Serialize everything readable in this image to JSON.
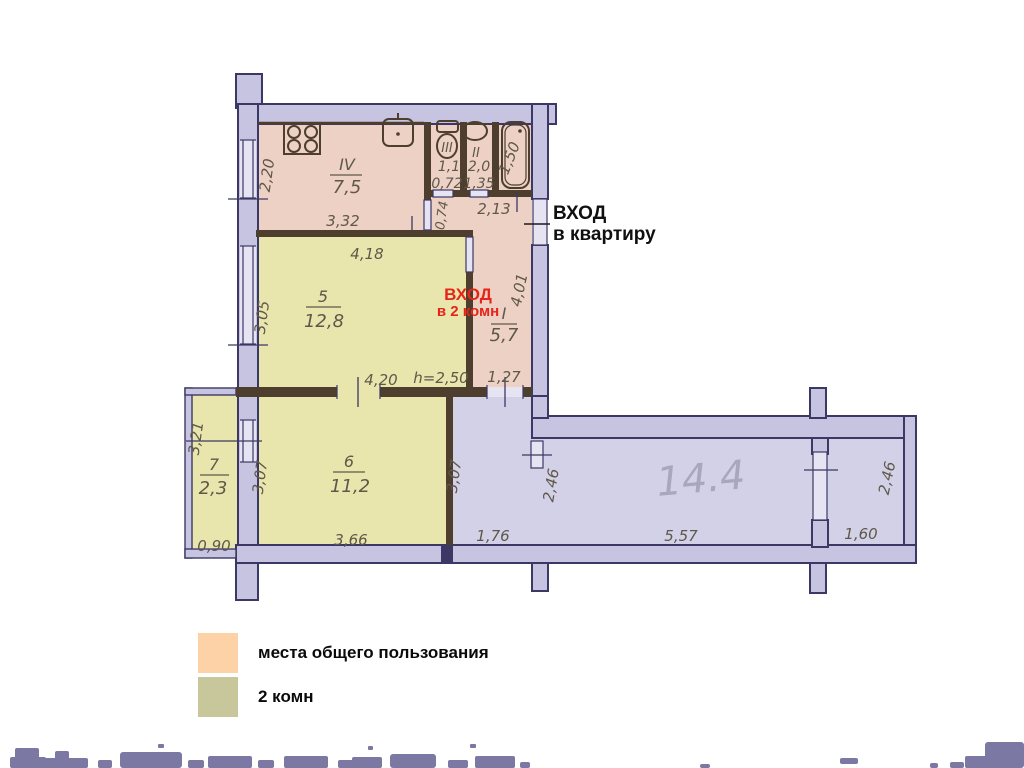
{
  "plan": {
    "rooms": {
      "kitchen": {
        "number": "IV",
        "area": "7,5",
        "dim_left": "2,20",
        "dim_bottom": "3,32"
      },
      "wc": {
        "fixture_mark": "III",
        "area_top": "1,1",
        "area_bottom": "0,72",
        "dim_bottom": "0,74"
      },
      "bathroom": {
        "fixture_mark": "II",
        "area_top": "2,0",
        "area_bottom": "1,35",
        "dim_bottom": "2,13"
      },
      "bath_niche": {
        "dim_width": "1,50"
      },
      "hall": {
        "number": "I",
        "area": "5,7",
        "dim_right": "4,01",
        "dim_bottom": "1,27"
      },
      "room5": {
        "number": "5",
        "area": "12,8",
        "dim_top": "4,18",
        "dim_left": "3,05",
        "dim_bottom": "4,20",
        "ceiling_height": "h=2,50"
      },
      "room6": {
        "number": "6",
        "area": "11,2",
        "dim_left": "3,07",
        "dim_bottom": "3,66"
      },
      "balcony": {
        "number": "7",
        "area": "2,3",
        "dim_left": "3,21",
        "dim_bottom": "0,90"
      },
      "corridor": {
        "handwritten_area": "14.4",
        "dim_left": "3,07",
        "dim_bottom_left": "1,76",
        "dim_mid": "2,46",
        "dim_bottom_mid": "5,57",
        "dim_right": "2,46",
        "dim_bottom_right": "1,60"
      }
    },
    "labels": {
      "entrance_apartment": {
        "line1": "ВХОД",
        "line2": "в квартиру"
      },
      "entrance_two_rooms": {
        "line1": "ВХОД",
        "line2": "в 2 комн"
      }
    }
  },
  "legend": {
    "items": [
      {
        "id": "common-areas",
        "label": "места общего пользования",
        "color": "#fcd2a6"
      },
      {
        "id": "two-rooms",
        "label": "2 комн",
        "color": "#c8c69b"
      }
    ]
  },
  "colors": {
    "common_area_fill": "#edd1c5",
    "rooms_fill": "#e9e6ad",
    "corridor_fill": "#d3d1e7",
    "wall_fill": "#c6c4e0",
    "wall_outline": "#3c3865",
    "partition_brown": "#4d3e2d",
    "dimension_text": "#5f584a",
    "entrance_red": "#e62419",
    "pencil_gray": "#a39fb8"
  }
}
